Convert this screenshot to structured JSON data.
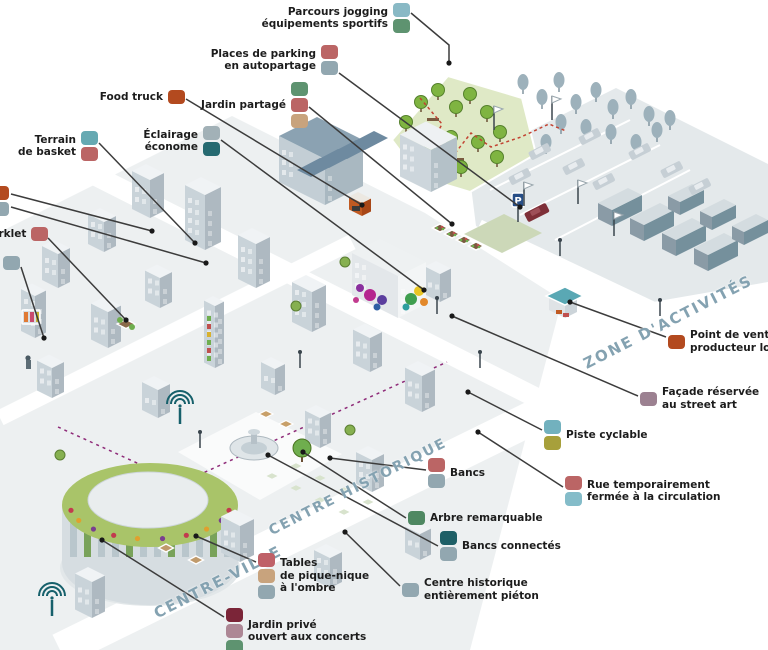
{
  "canvas": {
    "width": 768,
    "height": 650
  },
  "scene": {
    "parking_sign_label": "P"
  },
  "zones": [
    {
      "id": "zone-activites",
      "label": "ZONE D'ACTIVITÉS"
    },
    {
      "id": "centre-historique",
      "label": "CENTRE HISTORIQUE"
    },
    {
      "id": "centre-ville",
      "label": "CENTRE-VILLE"
    }
  ],
  "legend": {
    "line_color": "#3c3c3c",
    "items": [
      {
        "id": "parcours-jogging-equipements-sportifs",
        "lines": [
          "Parcours jogging",
          "équipements sportifs"
        ],
        "swatches": [
          "#89b9c5",
          "#5e9370"
        ],
        "swatch_side": "right",
        "pos": {
          "right": 358,
          "top": 3
        },
        "leaders": [
          [
            [
              411,
              13
            ],
            [
              449,
              45
            ],
            [
              449,
              63
            ]
          ]
        ]
      },
      {
        "id": "places-de-parking-en-autopartage",
        "lines": [
          "Places de parking",
          "en autopartage"
        ],
        "swatches": [
          "#bb6565",
          "#92a7b0"
        ],
        "swatch_side": "right",
        "pos": {
          "right": 430,
          "top": 45
        },
        "leaders": [
          [
            [
              339,
              73
            ],
            [
              520,
              207
            ]
          ]
        ]
      },
      {
        "id": "food-truck",
        "lines": [
          "Food truck"
        ],
        "swatches": [
          "#b34a1f"
        ],
        "swatch_side": "right",
        "pos": {
          "right": 583,
          "top": 90
        },
        "leaders": [
          [
            [
              186,
              99
            ],
            [
              362,
              205
            ]
          ]
        ]
      },
      {
        "id": "jardin-partage",
        "lines": [
          "Jardin partagé"
        ],
        "swatches": [
          "#5e9370",
          "#bb6565",
          "#c8a37d"
        ],
        "swatch_side": "right",
        "pos": {
          "right": 460,
          "top": 82
        },
        "leaders": [
          [
            [
              309,
              107
            ],
            [
              452,
              224
            ]
          ]
        ]
      },
      {
        "id": "eclairage-econome",
        "lines": [
          "Éclairage",
          "économe"
        ],
        "swatches": [
          "#a2b1b7",
          "#266a71"
        ],
        "swatch_side": "right",
        "pos": {
          "right": 548,
          "top": 126
        },
        "leaders": [
          [
            [
              221,
              140
            ],
            [
              424,
              290
            ]
          ]
        ]
      },
      {
        "id": "terrain-de-basket",
        "lines": [
          "Terrain",
          "de basket"
        ],
        "swatches": [
          "#66a9b2",
          "#bb6565"
        ],
        "swatch_side": "right",
        "pos": {
          "right": 670,
          "top": 131
        },
        "leaders": [
          [
            [
              99,
              143
            ],
            [
              195,
              243
            ]
          ]
        ]
      },
      {
        "id": "legend-cut-left-1",
        "lines": [],
        "swatches": [
          "#b34a1f",
          "#92a7b0"
        ],
        "swatch_side": "right",
        "pos": {
          "left": -8,
          "top": 186
        },
        "leaders": [
          [
            [
              11,
              194
            ],
            [
              152,
              231
            ]
          ],
          [
            [
              11,
              207
            ],
            [
              206,
              263
            ]
          ]
        ]
      },
      {
        "id": "parklet",
        "lines": [
          "Parklet"
        ],
        "swatches": [
          "#bb6565"
        ],
        "swatch_side": "right",
        "pos": {
          "left": -16,
          "top": 227
        },
        "leaders": [
          [
            [
              48,
              238
            ],
            [
              126,
              320
            ]
          ]
        ]
      },
      {
        "id": "legend-cut-left-2",
        "lines": [],
        "swatches": [
          "#92a7b0"
        ],
        "swatch_side": "right",
        "pos": {
          "left": 3,
          "top": 256
        },
        "leaders": [
          [
            [
              21,
              267
            ],
            [
              44,
              338
            ]
          ]
        ]
      },
      {
        "id": "point-de-vente-producteur-local",
        "lines": [
          "Point de vente",
          "producteur local"
        ],
        "swatches": [
          "#b34a1f"
        ],
        "swatch_side": "left",
        "pos": {
          "left": 668,
          "top": 329
        },
        "leaders": [
          [
            [
              666,
              337
            ],
            [
              570,
              302
            ]
          ]
        ]
      },
      {
        "id": "facade-reservee-au-street-art",
        "lines": [
          "Façade réservée",
          "au street art"
        ],
        "swatches": [
          "#9c8191"
        ],
        "swatch_side": "left",
        "pos": {
          "left": 640,
          "top": 386
        },
        "leaders": [
          [
            [
              638,
              396
            ],
            [
              452,
              316
            ]
          ]
        ]
      },
      {
        "id": "piste-cyclable",
        "lines": [
          "Piste cyclable"
        ],
        "swatches": [
          "#72b1be",
          "#a7a03b"
        ],
        "swatch_side": "left",
        "pos": {
          "left": 544,
          "top": 420
        },
        "leaders": [
          [
            [
              542,
              430
            ],
            [
              468,
              392
            ]
          ]
        ]
      },
      {
        "id": "rue-temporairement-fermee-a-la-circulation",
        "lines": [
          "Rue temporairement",
          "fermée à la circulation"
        ],
        "swatches": [
          "#bb6565",
          "#84bcc9"
        ],
        "swatch_side": "left",
        "pos": {
          "left": 565,
          "top": 476
        },
        "leaders": [
          [
            [
              563,
              487
            ],
            [
              478,
              432
            ]
          ]
        ]
      },
      {
        "id": "bancs",
        "lines": [
          "Bancs"
        ],
        "swatches": [
          "#bb6565",
          "#92a7b0"
        ],
        "swatch_side": "left",
        "pos": {
          "left": 428,
          "top": 458
        },
        "leaders": [
          [
            [
              426,
              470
            ],
            [
              330,
              458
            ]
          ]
        ]
      },
      {
        "id": "arbre-remarquable",
        "lines": [
          "Arbre remarquable"
        ],
        "swatches": [
          "#4f8862"
        ],
        "swatch_side": "left",
        "pos": {
          "left": 408,
          "top": 511
        },
        "leaders": [
          [
            [
              406,
              518
            ],
            [
              303,
              452
            ]
          ]
        ]
      },
      {
        "id": "bancs-connectes",
        "lines": [
          "Bancs connectés"
        ],
        "swatches": [
          "#1e5f66",
          "#92a7b0"
        ],
        "swatch_side": "left",
        "pos": {
          "left": 440,
          "top": 531
        },
        "leaders": [
          [
            [
              438,
              546
            ],
            [
              268,
              455
            ]
          ]
        ]
      },
      {
        "id": "centre-historique-entierement-pieton",
        "lines": [
          "Centre historique",
          "entièrement piéton"
        ],
        "swatches": [
          "#92a7b0"
        ],
        "swatch_side": "left",
        "pos": {
          "left": 402,
          "top": 577
        },
        "leaders": [
          [
            [
              400,
              586
            ],
            [
              345,
              532
            ]
          ]
        ]
      },
      {
        "id": "tables-de-pique-nique-a-l-ombre",
        "lines": [
          "Tables",
          "de pique-nique",
          "à l'ombre"
        ],
        "swatches": [
          "#bf6168",
          "#c8a37d",
          "#92a7b0"
        ],
        "swatch_side": "left",
        "pos": {
          "left": 258,
          "top": 553
        },
        "leaders": [
          [
            [
              256,
              562
            ],
            [
              196,
              536
            ]
          ]
        ]
      },
      {
        "id": "jardin-prive-ouvert-aux-concerts",
        "lines": [
          "Jardin privé",
          "ouvert aux concerts"
        ],
        "swatches": [
          "#7b2538",
          "#ad8795",
          "#5e9370"
        ],
        "swatch_side": "left",
        "pos": {
          "left": 226,
          "top": 608
        },
        "leaders": [
          [
            [
              224,
              617
            ],
            [
              102,
              540
            ]
          ]
        ]
      }
    ]
  }
}
